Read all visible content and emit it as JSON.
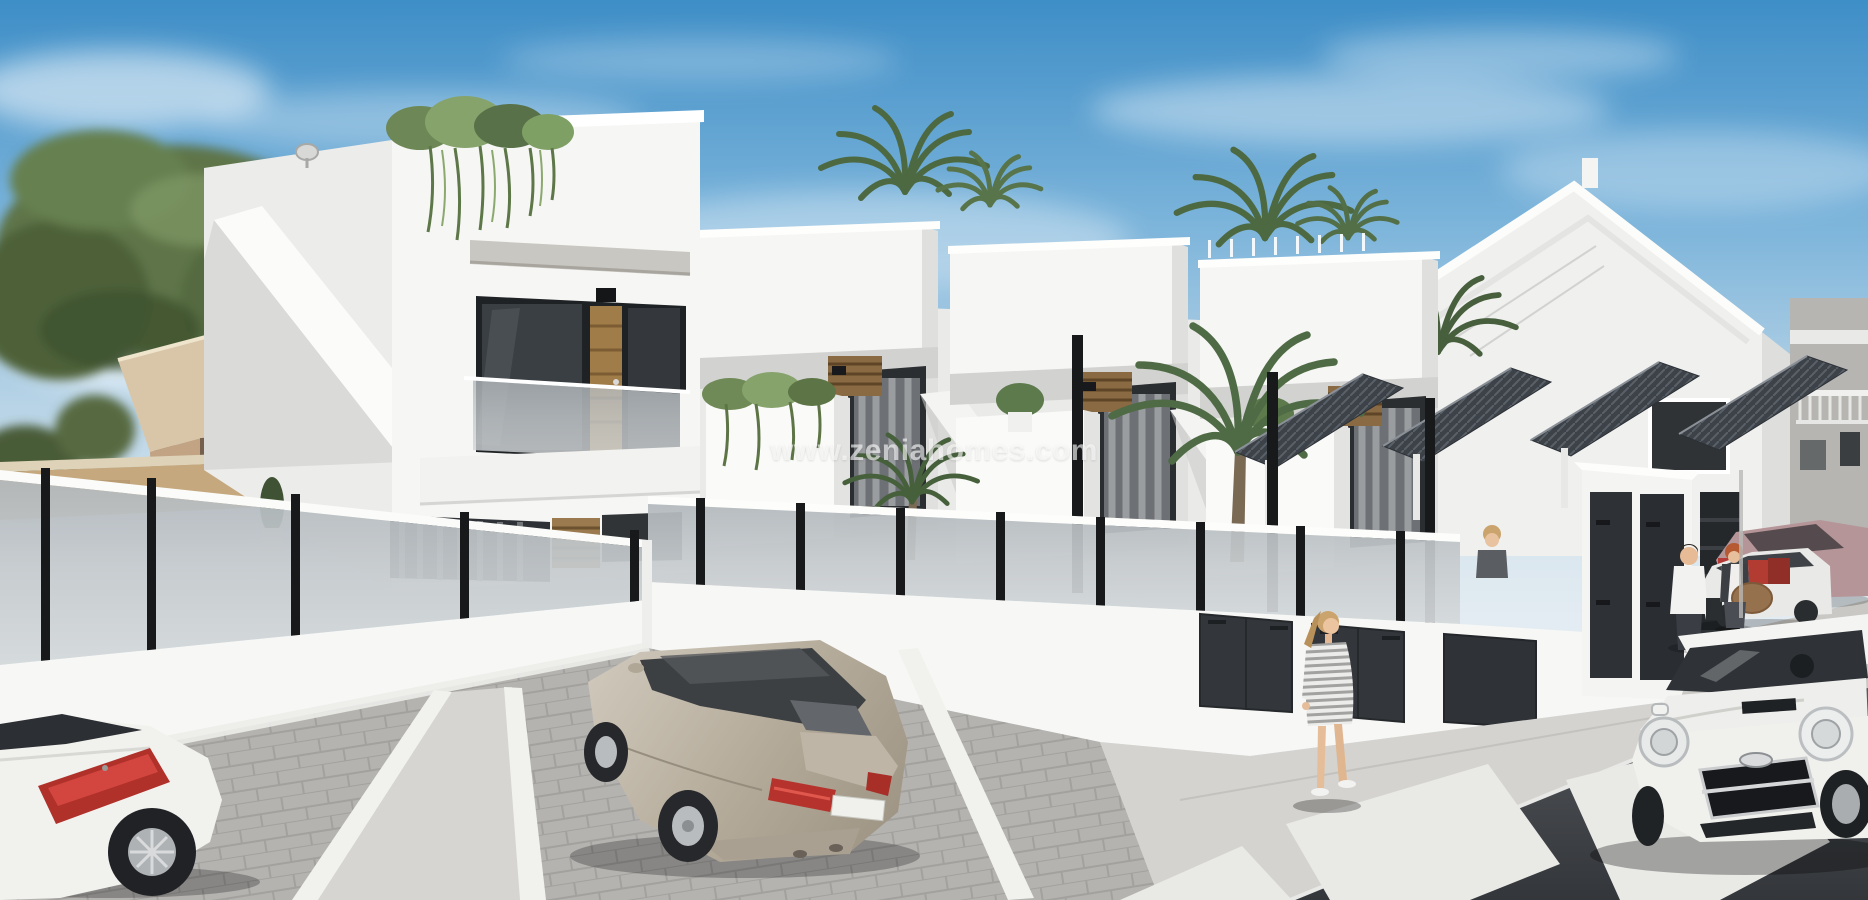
{
  "watermark": {
    "text": "www.zeniahomes.com"
  },
  "scene": {
    "type": "architectural-render",
    "description": "3D exterior render of new-build white Mediterranean townhouses with roof terraces, glass privacy fences, pergola carports, parking bays, street with zebra crossing, pedestrians and parked cars",
    "objects": [
      "sky-with-clouds",
      "pine-trees",
      "background-house-left",
      "stone-boundary-wall",
      "main-townhouse",
      "townhouse-unit-1",
      "townhouse-unit-2",
      "townhouse-unit-3",
      "gabled-house",
      "background-building-right",
      "roof-terrace-ivy",
      "palm-trees",
      "concrete-lintel",
      "terrace-door-gold",
      "glass-balustrade",
      "privacy-fence-left",
      "privacy-fence-right",
      "pergola-carports",
      "garage-doors",
      "utility-cabinets",
      "parking-area",
      "parking-lines",
      "sidewalk",
      "road",
      "crosswalk",
      "car-white-coupe",
      "car-champagne-sedan",
      "car-mini-cooper",
      "car-white-sedan",
      "car-mauve-sedan",
      "person-woman-walking",
      "person-man-white-shirt",
      "person-woman-redhead",
      "person-behind-fence"
    ],
    "colors": {
      "sky_top": "#3e8ec7",
      "sky_horizon": "#e3ecf2",
      "building_white": "#f6f6f4",
      "building_shade": "#dedddb",
      "fence_glass": "#c0c6ca",
      "fence_post": "#17191b",
      "wood_accent": "#8a6a42",
      "gold_door": "#a07c48",
      "foliage": "#5d7549",
      "road": "#3a3d41",
      "pavers": "#b4b3b0",
      "sidewalk": "#d4d3cf",
      "crosswalk": "#e9e9e6",
      "car_champagne": "#b3a998",
      "car_white": "#f1f1ee",
      "car_mini": "#f0f0ed",
      "car_mauve": "#b59598",
      "taillight_red": "#b5332c",
      "luggage_red": "#b23c31",
      "skin": "#e8bf9c",
      "hair_blonde": "#caa36d",
      "hair_red": "#b55a33"
    }
  }
}
